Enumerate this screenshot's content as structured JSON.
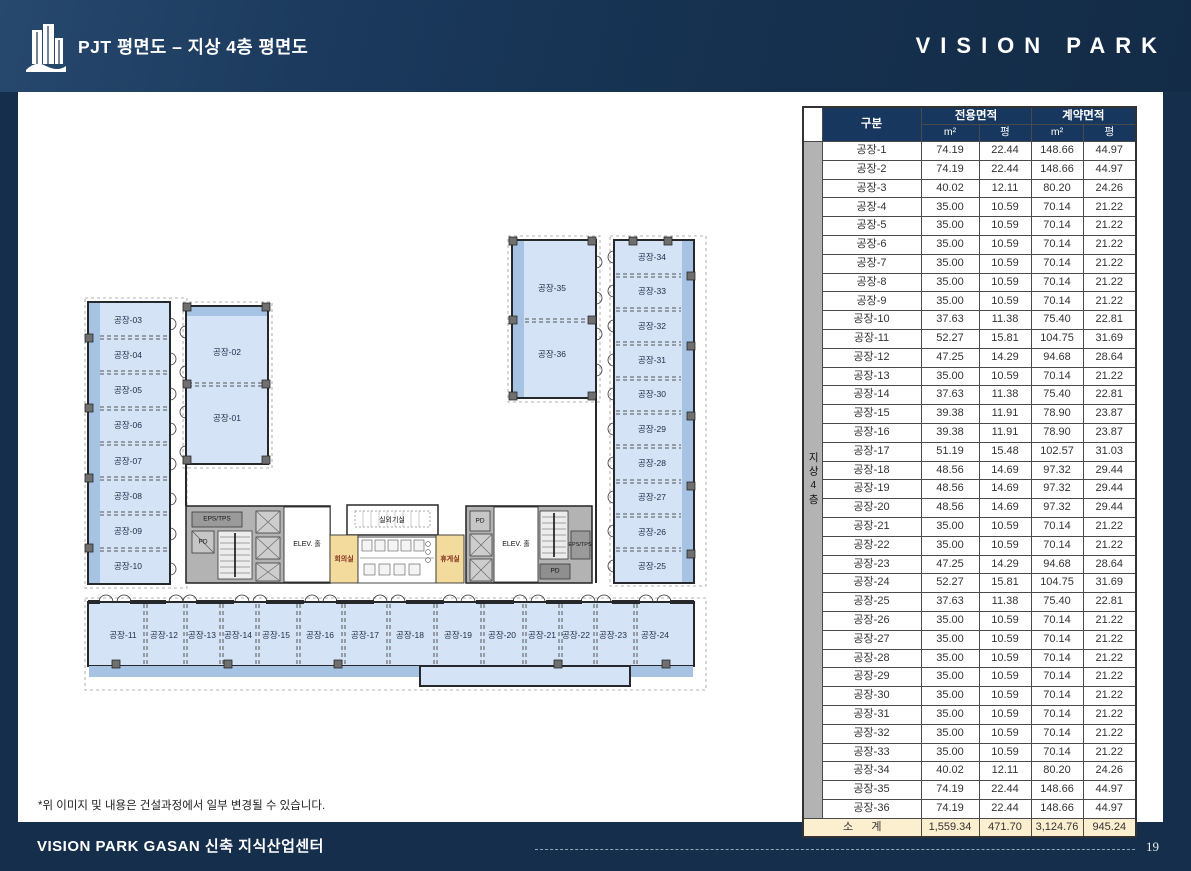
{
  "header": {
    "title": "PJT 평면도 – 지상 4층 평면도",
    "brand": "VISION PARK"
  },
  "footer": {
    "disclaimer": "*위 이미지 및 내용은 건설과정에서 일부 변경될 수 있습니다.",
    "project": "VISION PARK GASAN 신축 지식산업센터",
    "page": "19"
  },
  "table": {
    "col_group": "구분",
    "grp_exclusive": "전용면적",
    "grp_contract": "계약면적",
    "unit_m2": "m²",
    "unit_py": "평",
    "floor_band": "지상4층",
    "rows": [
      {
        "name": "공장-1",
        "values": [
          "74.19",
          "22.44",
          "148.66",
          "44.97"
        ]
      },
      {
        "name": "공장-2",
        "values": [
          "74.19",
          "22.44",
          "148.66",
          "44.97"
        ]
      },
      {
        "name": "공장-3",
        "values": [
          "40.02",
          "12.11",
          "80.20",
          "24.26"
        ]
      },
      {
        "name": "공장-4",
        "values": [
          "35.00",
          "10.59",
          "70.14",
          "21.22"
        ]
      },
      {
        "name": "공장-5",
        "values": [
          "35.00",
          "10.59",
          "70.14",
          "21.22"
        ]
      },
      {
        "name": "공장-6",
        "values": [
          "35.00",
          "10.59",
          "70.14",
          "21.22"
        ]
      },
      {
        "name": "공장-7",
        "values": [
          "35.00",
          "10.59",
          "70.14",
          "21.22"
        ]
      },
      {
        "name": "공장-8",
        "values": [
          "35.00",
          "10.59",
          "70.14",
          "21.22"
        ]
      },
      {
        "name": "공장-9",
        "values": [
          "35.00",
          "10.59",
          "70.14",
          "21.22"
        ]
      },
      {
        "name": "공장-10",
        "values": [
          "37.63",
          "11.38",
          "75.40",
          "22.81"
        ]
      },
      {
        "name": "공장-11",
        "values": [
          "52.27",
          "15.81",
          "104.75",
          "31.69"
        ]
      },
      {
        "name": "공장-12",
        "values": [
          "47.25",
          "14.29",
          "94.68",
          "28.64"
        ]
      },
      {
        "name": "공장-13",
        "values": [
          "35.00",
          "10.59",
          "70.14",
          "21.22"
        ]
      },
      {
        "name": "공장-14",
        "values": [
          "37.63",
          "11.38",
          "75.40",
          "22.81"
        ]
      },
      {
        "name": "공장-15",
        "values": [
          "39.38",
          "11.91",
          "78.90",
          "23.87"
        ]
      },
      {
        "name": "공장-16",
        "values": [
          "39.38",
          "11.91",
          "78.90",
          "23.87"
        ]
      },
      {
        "name": "공장-17",
        "values": [
          "51.19",
          "15.48",
          "102.57",
          "31.03"
        ]
      },
      {
        "name": "공장-18",
        "values": [
          "48.56",
          "14.69",
          "97.32",
          "29.44"
        ]
      },
      {
        "name": "공장-19",
        "values": [
          "48.56",
          "14.69",
          "97.32",
          "29.44"
        ]
      },
      {
        "name": "공장-20",
        "values": [
          "48.56",
          "14.69",
          "97.32",
          "29.44"
        ]
      },
      {
        "name": "공장-21",
        "values": [
          "35.00",
          "10.59",
          "70.14",
          "21.22"
        ]
      },
      {
        "name": "공장-22",
        "values": [
          "35.00",
          "10.59",
          "70.14",
          "21.22"
        ]
      },
      {
        "name": "공장-23",
        "values": [
          "47.25",
          "14.29",
          "94.68",
          "28.64"
        ]
      },
      {
        "name": "공장-24",
        "values": [
          "52.27",
          "15.81",
          "104.75",
          "31.69"
        ]
      },
      {
        "name": "공장-25",
        "values": [
          "37.63",
          "11.38",
          "75.40",
          "22.81"
        ]
      },
      {
        "name": "공장-26",
        "values": [
          "35.00",
          "10.59",
          "70.14",
          "21.22"
        ]
      },
      {
        "name": "공장-27",
        "values": [
          "35.00",
          "10.59",
          "70.14",
          "21.22"
        ]
      },
      {
        "name": "공장-28",
        "values": [
          "35.00",
          "10.59",
          "70.14",
          "21.22"
        ]
      },
      {
        "name": "공장-29",
        "values": [
          "35.00",
          "10.59",
          "70.14",
          "21.22"
        ]
      },
      {
        "name": "공장-30",
        "values": [
          "35.00",
          "10.59",
          "70.14",
          "21.22"
        ]
      },
      {
        "name": "공장-31",
        "values": [
          "35.00",
          "10.59",
          "70.14",
          "21.22"
        ]
      },
      {
        "name": "공장-32",
        "values": [
          "35.00",
          "10.59",
          "70.14",
          "21.22"
        ]
      },
      {
        "name": "공장-33",
        "values": [
          "35.00",
          "10.59",
          "70.14",
          "21.22"
        ]
      },
      {
        "name": "공장-34",
        "values": [
          "40.02",
          "12.11",
          "80.20",
          "24.26"
        ]
      },
      {
        "name": "공장-35",
        "values": [
          "74.19",
          "22.44",
          "148.66",
          "44.97"
        ]
      },
      {
        "name": "공장-36",
        "values": [
          "74.19",
          "22.44",
          "148.66",
          "44.97"
        ]
      }
    ],
    "subtotal": {
      "name": "소      계",
      "values": [
        "1,559.34",
        "471.70",
        "3,124.76",
        "945.24"
      ]
    }
  },
  "plan": {
    "labels": [
      {
        "t": "공장-03",
        "x": 44,
        "y": 88,
        "k": "room"
      },
      {
        "t": "공장-04",
        "x": 44,
        "y": 123,
        "k": "room"
      },
      {
        "t": "공장-05",
        "x": 44,
        "y": 158,
        "k": "room"
      },
      {
        "t": "공장-06",
        "x": 44,
        "y": 193,
        "k": "room"
      },
      {
        "t": "공장-07",
        "x": 44,
        "y": 229,
        "k": "room"
      },
      {
        "t": "공장-08",
        "x": 44,
        "y": 264,
        "k": "room"
      },
      {
        "t": "공장-09",
        "x": 44,
        "y": 299,
        "k": "room"
      },
      {
        "t": "공장-10",
        "x": 44,
        "y": 334,
        "k": "room"
      },
      {
        "t": "공장-02",
        "x": 143,
        "y": 120,
        "k": "room"
      },
      {
        "t": "공장-01",
        "x": 143,
        "y": 186,
        "k": "room"
      },
      {
        "t": "공장-35",
        "x": 468,
        "y": 56,
        "k": "room"
      },
      {
        "t": "공장-36",
        "x": 468,
        "y": 122,
        "k": "room"
      },
      {
        "t": "공장-34",
        "x": 568,
        "y": 25,
        "k": "room"
      },
      {
        "t": "공장-33",
        "x": 568,
        "y": 59,
        "k": "room"
      },
      {
        "t": "공장-32",
        "x": 568,
        "y": 94,
        "k": "room"
      },
      {
        "t": "공장-31",
        "x": 568,
        "y": 128,
        "k": "room"
      },
      {
        "t": "공장-30",
        "x": 568,
        "y": 162,
        "k": "room"
      },
      {
        "t": "공장-29",
        "x": 568,
        "y": 197,
        "k": "room"
      },
      {
        "t": "공장-28",
        "x": 568,
        "y": 231,
        "k": "room"
      },
      {
        "t": "공장-27",
        "x": 568,
        "y": 265,
        "k": "room"
      },
      {
        "t": "공장-26",
        "x": 568,
        "y": 300,
        "k": "room"
      },
      {
        "t": "공장-25",
        "x": 568,
        "y": 334,
        "k": "room"
      },
      {
        "t": "공장-11",
        "x": 39,
        "y": 403,
        "k": "room"
      },
      {
        "t": "공장-12",
        "x": 80,
        "y": 403,
        "k": "room"
      },
      {
        "t": "공장-13",
        "x": 118,
        "y": 403,
        "k": "room"
      },
      {
        "t": "공장-14",
        "x": 154,
        "y": 403,
        "k": "room"
      },
      {
        "t": "공장-15",
        "x": 192,
        "y": 403,
        "k": "room"
      },
      {
        "t": "공장-16",
        "x": 236,
        "y": 403,
        "k": "room"
      },
      {
        "t": "공장-17",
        "x": 281,
        "y": 403,
        "k": "room"
      },
      {
        "t": "공장-18",
        "x": 326,
        "y": 403,
        "k": "room"
      },
      {
        "t": "공장-19",
        "x": 374,
        "y": 403,
        "k": "room"
      },
      {
        "t": "공장-20",
        "x": 418,
        "y": 403,
        "k": "room"
      },
      {
        "t": "공장-21",
        "x": 458,
        "y": 403,
        "k": "room"
      },
      {
        "t": "공장-22",
        "x": 492,
        "y": 403,
        "k": "room"
      },
      {
        "t": "공장-23",
        "x": 529,
        "y": 403,
        "k": "room"
      },
      {
        "t": "공장-24",
        "x": 571,
        "y": 403,
        "k": "room"
      },
      {
        "t": "EPS/TPS",
        "x": 133,
        "y": 287,
        "k": "core"
      },
      {
        "t": "PD",
        "x": 119,
        "y": 310,
        "k": "core"
      },
      {
        "t": "ELEV. 홀",
        "x": 223,
        "y": 312,
        "k": "hall"
      },
      {
        "t": "실외기실",
        "x": 308,
        "y": 288,
        "k": "hall"
      },
      {
        "t": "회의실",
        "x": 260,
        "y": 327,
        "k": "amen"
      },
      {
        "t": "휴게실",
        "x": 366,
        "y": 327,
        "k": "amen"
      },
      {
        "t": "PD",
        "x": 396,
        "y": 289,
        "k": "core"
      },
      {
        "t": "ELEV. 홀",
        "x": 432,
        "y": 312,
        "k": "hall"
      },
      {
        "t": "EPS/TPS",
        "x": 496,
        "y": 313,
        "k": "core2"
      },
      {
        "t": "PD",
        "x": 471,
        "y": 339,
        "k": "core"
      }
    ]
  }
}
